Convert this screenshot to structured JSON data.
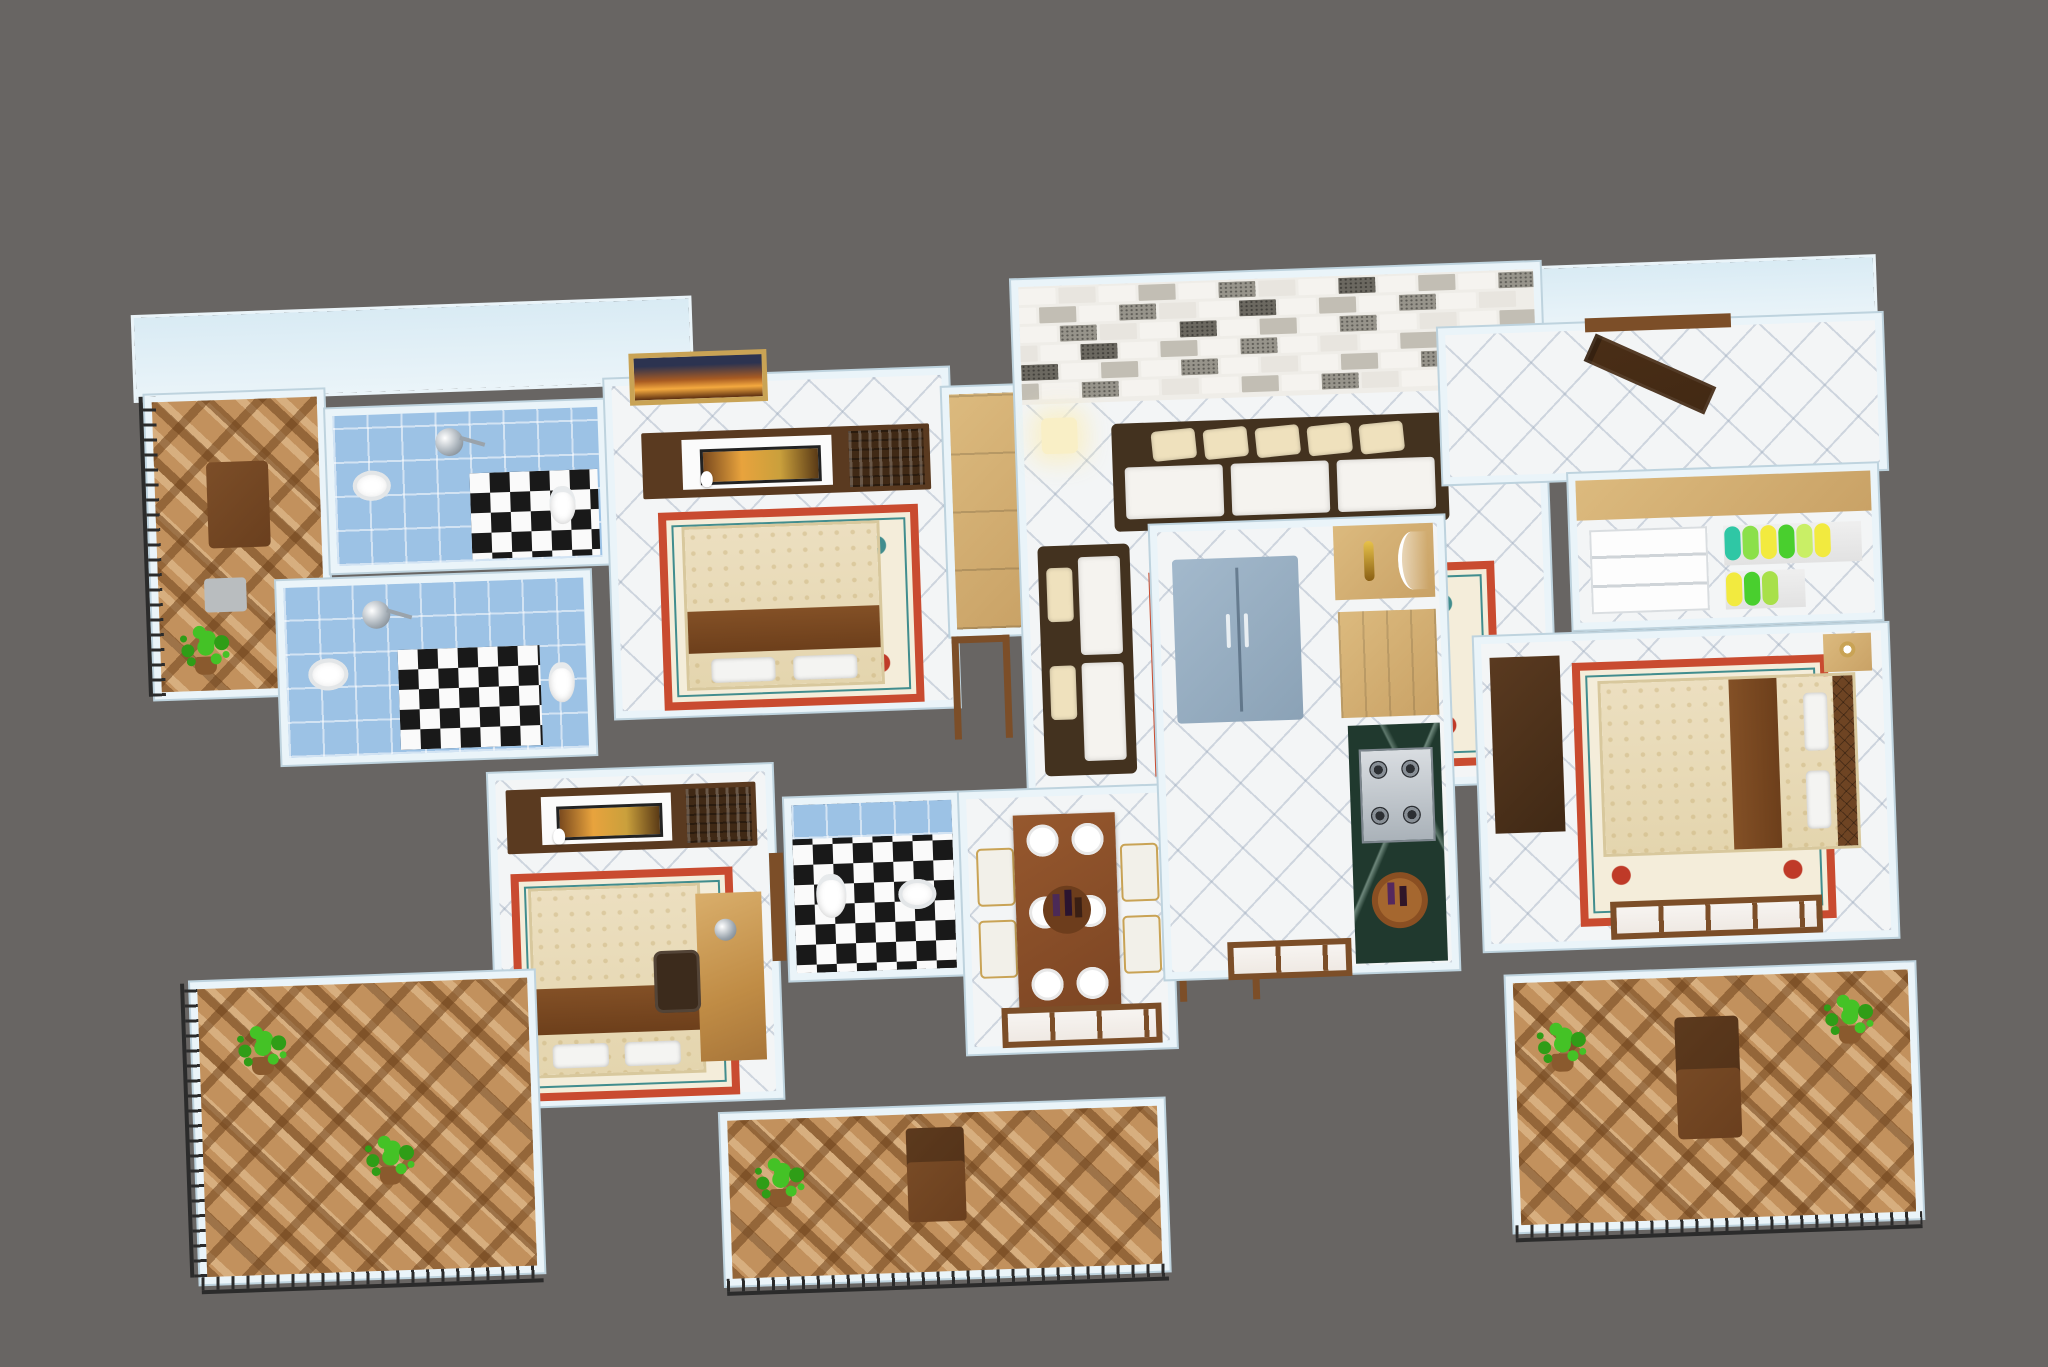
{
  "scene": {
    "type": "3d-floor-plan-render",
    "description": "Isometric 3D rendering of a 3-bedroom apartment floor plan with furniture, four balconies, three bathrooms, living room with brick accent wall, dining area, kitchen and dressing closet, on a plain gray backdrop",
    "background_color": "#686563",
    "visible_text": ""
  },
  "palette": {
    "bg": "#686563",
    "wall": "#eaf4f9",
    "wall_edge": "#bed3de",
    "wall_face": "#d9ebf4",
    "tile": "#f3f5f6",
    "btile": "#c2915d",
    "blue": "#9cc2e5",
    "checker_dark": "#191919",
    "checker_light": "#fafafa",
    "wood_light": "#dcba7e",
    "wood_mid": "#7c4e28",
    "wood_dark": "#5a3a20",
    "wood_deep": "#402915",
    "marble": "#20392e",
    "fridge": "#a3b9cc",
    "fridge_edge": "#8ba2b6",
    "sofa_frame": "#43321f",
    "cushion": "#f5f3ef",
    "pillow": "#efe1bd",
    "rug_border": "#c94b30",
    "rug_field": "#f4edda",
    "rug_teal": "#418d8e",
    "rug_red": "#bf3a28",
    "plant": "#44c226",
    "plant_dark": "#2f9d17",
    "pot": "#8a5a2e",
    "railing": "#2b2b2b",
    "gold": "#c9a355",
    "screen": "#e8a33d",
    "glow": "#f9efc6",
    "chair": "#f2f0e9",
    "plate": "#ffffff",
    "door": "#422914",
    "frame_art": "#f4a93f"
  },
  "brick_wall": {
    "rows": 6,
    "cols": 13,
    "colors": [
      "#f5f3ef",
      "#e8e5df",
      "#c2beb4",
      "#97948b",
      "#6b6860"
    ]
  },
  "living": {
    "sofa_pillow_count": 5,
    "chaise_pillow_count": 2,
    "floor_lamp_count": 2
  },
  "dining": {
    "plate_count": 6,
    "chair_count": 4,
    "table_items": [
      "wine-bottles",
      "candles",
      "glasses"
    ]
  },
  "closet": {
    "rail1_colors": [
      "#2fc7a5",
      "#8be04a",
      "#f2ea3f",
      "#49cf2e",
      "#c9ef66",
      "#f2ea3f"
    ],
    "rail2_colors": [
      "#f2ea3f",
      "#49cf2e",
      "#a8e04a"
    ]
  },
  "rooms": [
    {
      "label": "balcony top-left",
      "floor": "brown-diamond-tiles",
      "items": [
        "railing",
        "lounge-chair",
        "side-table",
        "potted-plant"
      ]
    },
    {
      "label": "bathroom 1",
      "floor": "blue-tile + black-white-checker",
      "items": [
        "shower",
        "washbasin",
        "toilet"
      ]
    },
    {
      "label": "bathroom 2",
      "floor": "blue-tile + black-white-checker",
      "items": [
        "shower",
        "washbasin",
        "toilet"
      ]
    },
    {
      "label": "bedroom 1",
      "floor": "white-diamond-tiles",
      "items": [
        "wall-picture",
        "tv-unit",
        "double-bed",
        "ornate-rug",
        "wardrobe"
      ]
    },
    {
      "label": "living room",
      "floor": "white-diamond-tiles",
      "items": [
        "brick-accent-wall",
        "floor-lamps",
        "three-seat-sofa",
        "chaise-sofa",
        "coffee-table",
        "ornate-rug",
        "tall-cabinet"
      ]
    },
    {
      "label": "bedroom 2",
      "floor": "white-diamond-tiles",
      "items": [
        "tv-unit",
        "double-bed",
        "ornate-rug",
        "study-desk",
        "desk-lamp",
        "office-chair"
      ]
    },
    {
      "label": "common bathroom",
      "floor": "black-white-checker",
      "items": [
        "blue-tile-wall",
        "toilet",
        "washbasin"
      ]
    },
    {
      "label": "dining area",
      "floor": "white-diamond-tiles",
      "items": [
        "dining-table",
        "plates",
        "wine-bottles",
        "chairs",
        "window"
      ]
    },
    {
      "label": "balcony bottom-center",
      "floor": "brown-diamond-tiles",
      "items": [
        "door-frame",
        "potted-plant",
        "armchair",
        "railing"
      ]
    },
    {
      "label": "kitchen",
      "floor": "white-diamond-tiles",
      "items": [
        "refrigerator",
        "sideboard",
        "tall-cabinet",
        "green-marble-counter",
        "gas-stove",
        "breakfast-table",
        "window"
      ]
    },
    {
      "label": "entry foyer",
      "floor": "white-diamond-tiles",
      "items": [
        "entrance-door-open"
      ]
    },
    {
      "label": "dressing closet",
      "floor": "white-diamond-tiles",
      "items": [
        "overhead-cabinet",
        "drawer-unit",
        "hanging-clothes"
      ]
    },
    {
      "label": "bedroom 3",
      "floor": "white-diamond-tiles",
      "items": [
        "dark-wardrobe",
        "double-bed",
        "tufted-headboard",
        "nightstand-lamp",
        "ornate-rug",
        "windows"
      ]
    },
    {
      "label": "balcony bottom-right",
      "floor": "brown-diamond-tiles",
      "items": [
        "potted-plants",
        "lounge-chair",
        "railing"
      ]
    },
    {
      "label": "balcony bottom-left",
      "floor": "brown-diamond-tiles",
      "items": [
        "potted-plants",
        "railing"
      ]
    }
  ]
}
